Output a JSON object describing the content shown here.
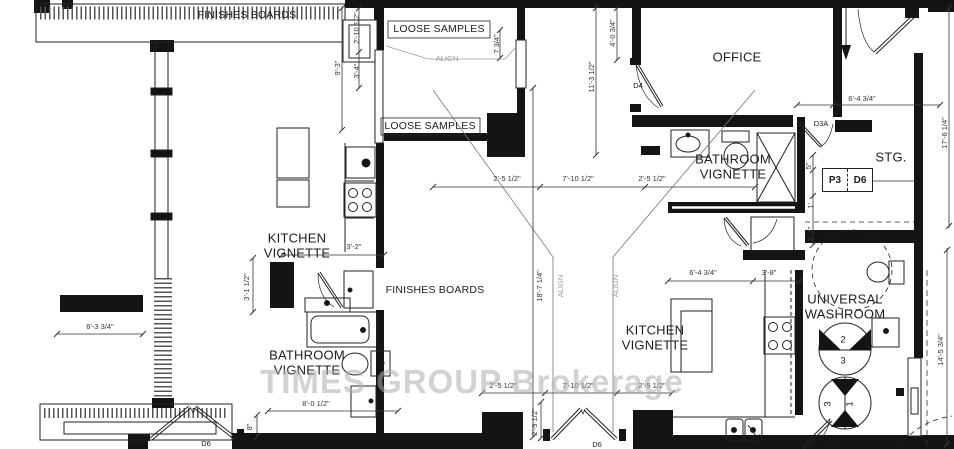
{
  "watermark": "TIMES GROUP Brokerage",
  "colors": {
    "wall": "#141414",
    "line": "#333333",
    "leader_gray": "#9a9a9a",
    "watermark_gray": "#adadad"
  },
  "rooms": {
    "finishes_boards_top": "FINISHES BOARDS",
    "loose_samples_upper": "LOOSE SAMPLES",
    "loose_samples_lower": "LOOSE SAMPLES",
    "office": "OFFICE",
    "kitchen_vignette_left": "KITCHEN\nVIGNETTE",
    "bathroom_vignette_left": "BATHROOM\nVIGNETTE",
    "finishes_boards_center": "FINISHES BOARDS",
    "bathroom_vignette_right": "BATHROOM\nVIGNETTE",
    "kitchen_vignette_right": "KITCHEN\nVIGNETTE",
    "storage": "STG.",
    "universal_washroom": "UNIVERSAL\nWASHROOM"
  },
  "doors": {
    "d4": "D4",
    "d3a": "D3A",
    "d6_left": "D6",
    "d6_center": "D6",
    "d3": "D3",
    "p3": "P3",
    "d6_tag": "D6"
  },
  "washroom_turning_numbers": {
    "n2": "2",
    "n3_upper": "3",
    "n3_lower": "3",
    "n1": "1"
  },
  "dimensions": {
    "v_9_3": "9'-3\"",
    "v_2_10_half": "2'-10 1/2\"",
    "v_3_4": "3'-4\"",
    "v_7_3q": "7 3/4\"",
    "v_4_0_3q": "4'-0 3/4\"",
    "v_11_3_half": "11'-3 1/2\"",
    "h_6_4_3q_top": "6'-4 3/4\"",
    "v_17_6_q": "17'-6 1/4\"",
    "h_2_5_half_a": "2'-5 1/2\"",
    "h_7_10_half_a": "7'-10 1/2\"",
    "h_2_5_half_b": "2'-5 1/2\"",
    "v_18_7_q": "18'-7 1/4\"",
    "align_top": "ALIGN",
    "align_left": "ALIGN",
    "align_right": "ALIGN",
    "h_3_2": "3'-2\"",
    "v_3_1_half": "3'-1 1/2\"",
    "h_6_3_3q": "6'-3 3/4\"",
    "h_8_0_half": "8'-0 1/2\"",
    "v_8in": "8\"",
    "h_2_5_half_c": "2'-5 1/2\"",
    "h_7_10_half_b": "7'-10 1/2\"",
    "h_2_5_half_d": "2'-5 1/2\"",
    "v_2_9_half": "2'-9 1/2\"",
    "h_6_4_3q_bot": "6'-4 3/4\"",
    "h_3_8": "3'-8\"",
    "v_5in": "5\"",
    "v_1ft": "1'",
    "v_3_4_right": "3'-4\"",
    "v_14_5_3q": "14'-5 3/4\""
  }
}
